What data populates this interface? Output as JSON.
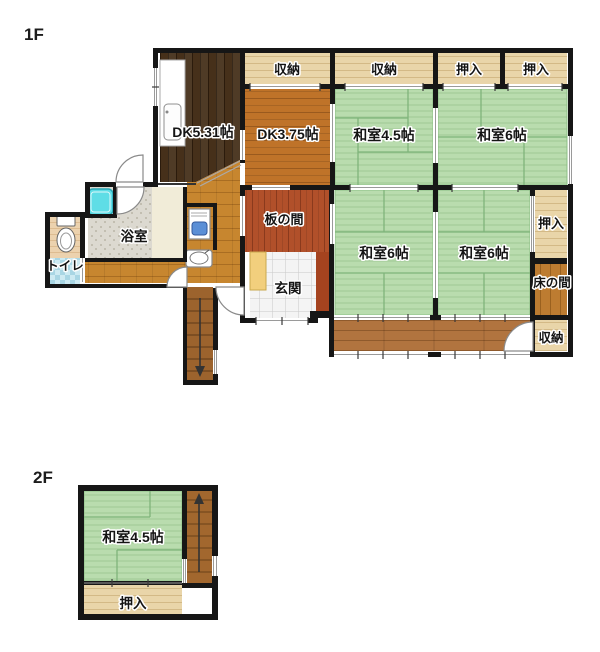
{
  "floor1": {
    "title": "1F",
    "rooms": {
      "closet_top_1": "収納",
      "closet_top_2": "収納",
      "oshiire_top_1": "押入",
      "oshiire_top_2": "押入",
      "dk531": "DK5.31帖",
      "dk375": "DK3.75帖",
      "washitsu45": "和室4.5帖",
      "washitsu6_top": "和室6帖",
      "itanoma": "板の間",
      "washitsu6_mid_left": "和室6帖",
      "washitsu6_mid_right": "和室6帖",
      "oshiire_right": "押入",
      "tokonoma": "床の間",
      "genkan": "玄関",
      "closet_bottom_right": "収納",
      "yokushitsu": "浴室",
      "toire": "トイレ"
    }
  },
  "floor2": {
    "title": "2F",
    "rooms": {
      "washitsu45": "和室4.5帖",
      "oshiire": "押入"
    }
  },
  "colors": {
    "wall": "#161616",
    "tatami_green": "#b9dcae",
    "closet_tan": "#e9d5a9",
    "dark_wood": "#46301a",
    "hall_wood": "#c7862f",
    "engawa_wood": "#b1743f",
    "bathtub_cyan": "#5fdde6"
  }
}
